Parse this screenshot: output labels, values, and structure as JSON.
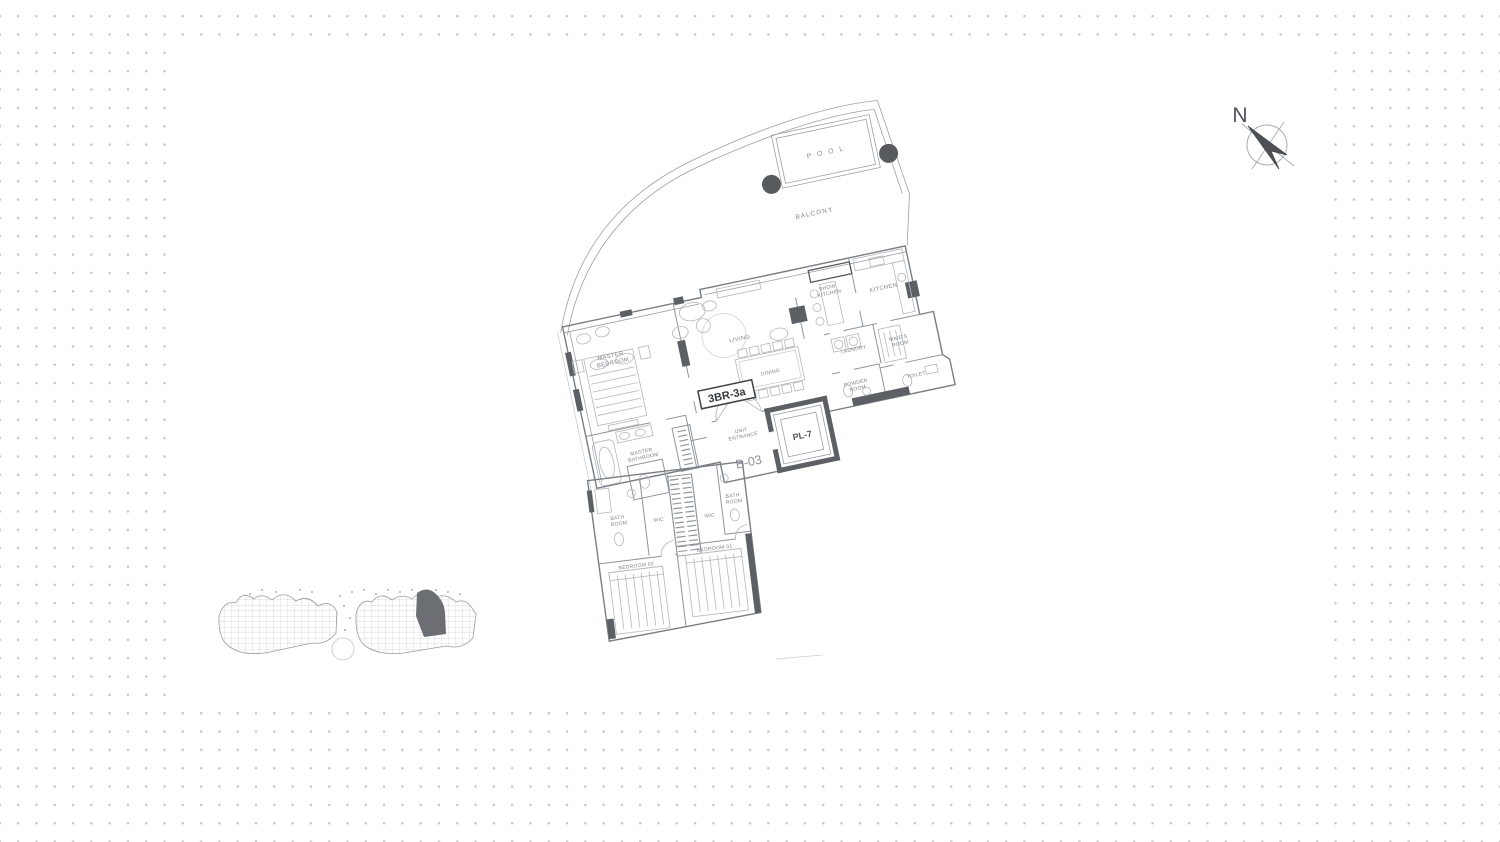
{
  "canvas": {
    "paper_color": "#ffffff",
    "dot_color": "#c7c7c7",
    "line_color": "#9aa0a6",
    "wall_dark_color": "#5c6064",
    "label_color": "#7c8288",
    "planter_color": "#585b5e"
  },
  "compass": {
    "north_label": "N"
  },
  "unit": {
    "type_label": "3BR-3a",
    "unit_code": "B-03",
    "lift_label": "PL-7"
  },
  "rooms": {
    "pool": "P O O L",
    "balcony": "BALCONY",
    "living": "LIVING",
    "dining": "DINING",
    "show_kitchen": [
      "SHOW",
      "KITCHEN"
    ],
    "kitchen": "KITCHEN",
    "laundry": "LAUNDRY",
    "maids_room": [
      "MAID'S",
      "ROOM"
    ],
    "toilet": "TOILET",
    "powder_room": [
      "POWDER",
      "ROOM"
    ],
    "master_bedroom": [
      "MASTER",
      "BEDROOM"
    ],
    "master_bathroom": [
      "MASTER",
      "BATHROOM"
    ],
    "unit_entrance": [
      "UNIT",
      "ENTRANCE"
    ],
    "bathroom_left": [
      "BATH",
      "ROOM"
    ],
    "wic_1": "WIC",
    "wic_2": "WIC",
    "bathroom_right": [
      "BATH",
      "ROOM"
    ],
    "bedroom_02": "BEDROOM 02",
    "bedroom_01": "BEDROOM 01"
  }
}
